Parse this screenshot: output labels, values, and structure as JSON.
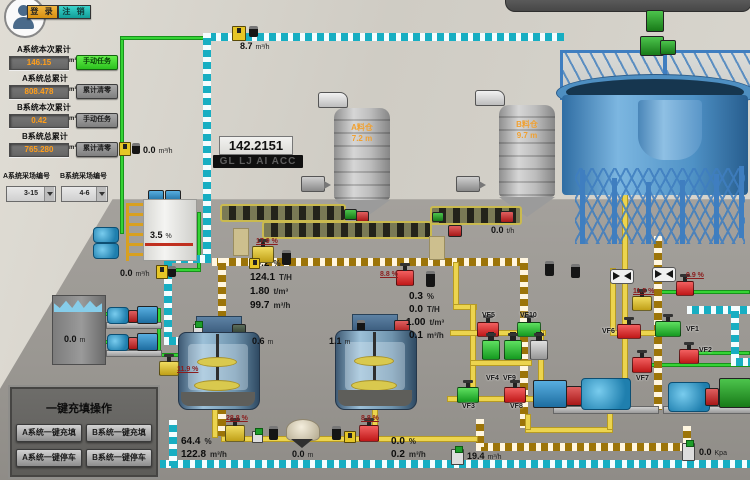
{
  "header": {
    "login": "登 录",
    "logout": "注 销"
  },
  "left_panel": {
    "a_current": {
      "label": "A系统本次累计",
      "value": "146.15",
      "unit": "m³",
      "button": "手动任务"
    },
    "a_total": {
      "label": "A系统总累计",
      "value": "808.478",
      "unit": "m³",
      "button": "累计清零"
    },
    "b_current": {
      "label": "B系统本次累计",
      "value": "0.42",
      "unit": "m³",
      "button": "手动任务"
    },
    "b_total": {
      "label": "B系统总累计",
      "value": "765.280",
      "unit": "m³",
      "button": "累计清零"
    },
    "a_site": {
      "label": "A系统采场编号",
      "value": "3-15"
    },
    "b_site": {
      "label": "B系统采场编号",
      "value": "4-6"
    }
  },
  "displays": {
    "totalizer": "142.2151",
    "code_bar": "GL LJ AI ACC"
  },
  "silos": {
    "a": {
      "name": "A料仓",
      "level": "7.2",
      "unit": "m"
    },
    "b": {
      "name": "B料仓",
      "level": "9.7",
      "unit": "m"
    }
  },
  "readouts": {
    "top_flow": {
      "value": "8.7",
      "unit": "m³/h"
    },
    "dosing_flow": {
      "value": "0.0",
      "unit": "m³/h"
    },
    "dosing_flow2": {
      "value": "0.0",
      "unit": "m³/h"
    },
    "additive_tank": {
      "value": "3.5",
      "unit": "%"
    },
    "feeder_a": {
      "value": "10.8",
      "unit": "t/h"
    },
    "feeder_b": {
      "value": "0.0",
      "unit": "t/h"
    },
    "mixer_a_level": {
      "value": "0.6",
      "unit": "m"
    },
    "mixer_b_level": {
      "value": "1.1",
      "unit": "m"
    },
    "water_tank_level": {
      "value": "0.0",
      "unit": "m"
    },
    "hopper_level": {
      "value": "0.0",
      "unit": "m"
    },
    "fill_flow": {
      "value": "19.4",
      "unit": "m³/h"
    },
    "pressure": {
      "value": "0.0",
      "unit": "Kpa"
    }
  },
  "metrics_a": [
    {
      "value": "69.2",
      "unit": "%"
    },
    {
      "value": "124.1",
      "unit": "T/H"
    },
    {
      "value": "1.80",
      "unit": "t/m³"
    },
    {
      "value": "99.7",
      "unit": "m³/h"
    }
  ],
  "metrics_b": [
    {
      "value": "0.3",
      "unit": "%"
    },
    {
      "value": "0.0",
      "unit": "T/H"
    },
    {
      "value": "1.00",
      "unit": "t/m³"
    },
    {
      "value": "0.1",
      "unit": "m³/h"
    }
  ],
  "metrics_fill": [
    {
      "value": "64.4",
      "unit": "%"
    },
    {
      "value": "122.8",
      "unit": "m³/h"
    }
  ],
  "metrics_b_line": [
    {
      "value": "0.0",
      "unit": "%"
    },
    {
      "value": "0.2",
      "unit": "m³/h"
    }
  ],
  "valves": {
    "vf1": "VF1",
    "vf2": "VF2",
    "vf3": "VF3",
    "vf4": "VF4",
    "vf5": "VF5",
    "vf6": "VF6",
    "vf7": "VF7",
    "vf8": "VF8",
    "vf9": "VF9",
    "vf10": "VF10"
  },
  "gauges": {
    "feed_line": "17.9 %",
    "slurry_a": "8.8 %",
    "underflow": "11.5 %",
    "overflow": "0.9 %",
    "water_line": "11.9 %",
    "mixer_a_out": "28.8 %",
    "mixer_b_out": "8.8 %"
  },
  "panel": {
    "title": "一键充填操作",
    "a_fill": "A系统一键充填",
    "b_fill": "B系统一键充填",
    "a_stop": "A系统一键停车",
    "b_stop": "B系统一键停车"
  },
  "colors": {
    "pipe_water_dashed": "#17aec2",
    "pipe_slurry_dashed": "#9c7408",
    "pipe_fill_yellow": "#ecd44e",
    "pipe_clean_green": "#35d435",
    "valve_open": "#159a20",
    "valve_closed": "#c01818",
    "valve_manual": "#c0a018",
    "login_accent": "#e8a11c",
    "logout_accent": "#18b2b2",
    "field_value_text": "#ff9e1b",
    "silo_label_text": "#f0a030"
  }
}
